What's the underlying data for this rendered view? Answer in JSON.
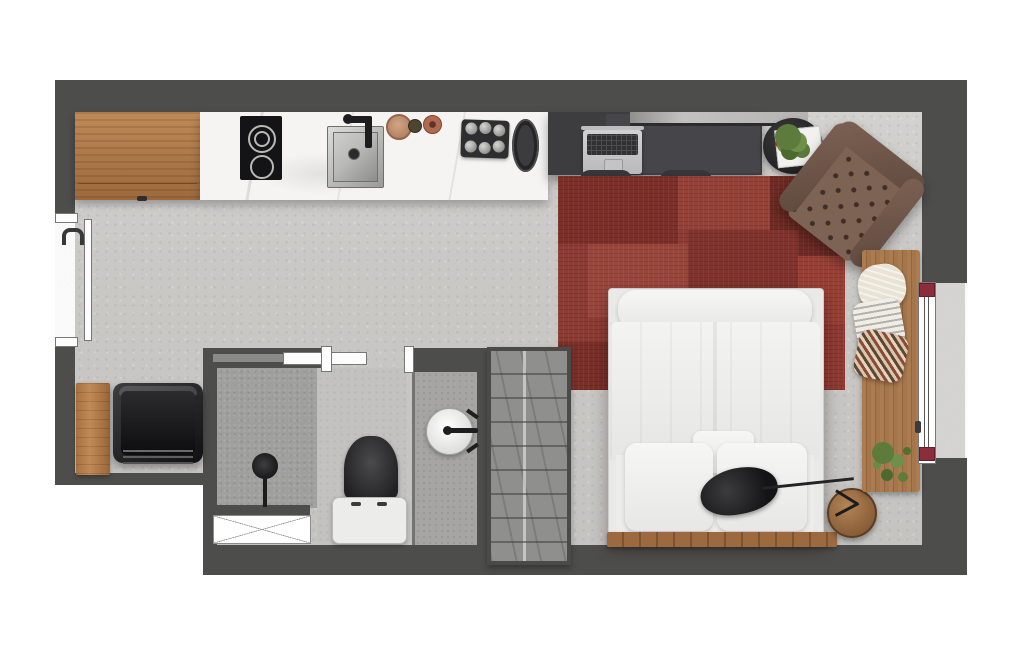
{
  "meta": {
    "type": "floor-plan",
    "description": "Top-down rendered floor plan of a studio apartment with kitchen, desk, bed, bathroom and window bench",
    "orientation": "top-down"
  },
  "colors": {
    "wall": "#4d4d4b",
    "outside": "#ffffff",
    "floor": "#cac9c6",
    "marble": "#f5f4f2",
    "wood": "#b07a4c",
    "rug": "#8e3b33",
    "desk": "#3d3d3f",
    "leather": "#6f5749",
    "bed": "#f0f0ee",
    "gray_counter": "#a5a4a2",
    "shower": "#9e9e9c",
    "bath_floor": "#c4c3c1",
    "balcony": "#d7d6d4",
    "plant": "#5d7b3c",
    "accent_red": "#8e2d3a",
    "black": "#1e1e20",
    "steel": "#c9c9c7",
    "wardrobe_gray": "#8f8f8d"
  },
  "rooms": {
    "kitchen": "Kitchen",
    "living": "Living and sleeping area",
    "bathroom": "Bathroom",
    "entry": "Entry"
  },
  "items": {
    "entry_door": "Entry door",
    "kitchen_cabinet": "Wood kitchen cabinet",
    "kitchen_counter": "Marble kitchen counter",
    "cooktop": "Two-burner cooktop",
    "kitchen_sink": "Kitchen sink with black faucet",
    "serving_board_large": "Large round serving board",
    "serving_board_small": "Small round serving board",
    "serving_board_medium": "Medium round serving board",
    "glass_tray": "Tray with six glasses",
    "platter": "Oval platter",
    "desk": "Work desk",
    "desk_shelf": "Wall shelf above desk",
    "laptop": "Open laptop",
    "desk_chair_left": "Wire desk chair",
    "desk_chair_right": "Wire desk chair",
    "plant_tray": "Round side tray with potted plant and magazine",
    "armchair": "Tufted leather armchair",
    "rug": "Red patchwork rug",
    "bed": "Double bed with duvet",
    "pillow_left": "Bed pillow",
    "pillow_right": "Bed pillow",
    "pillow_small": "Small center pillow",
    "bed_slats": "Wood slat headboard strip",
    "nightstand": "Round wood nightstand",
    "lamp": "Black task lamp",
    "window_bench": "Slatted wood window bench",
    "bench_pillow_fur": "Cream fur pillow",
    "bench_pillow_print": "Printed pillow",
    "bench_pillow_chevron": "Chevron pillow",
    "bench_plant": "Potted plant on bench",
    "window": "Window with red corner caps",
    "balcony": "Balcony slab",
    "lounge_chair": "Black lounge chair",
    "side_table": "Wood side board",
    "wardrobe": "Wardrobe with shelves",
    "sliding_door": "Sliding bathroom door",
    "door_jamb": "Door jamb",
    "shower": "Shower area",
    "shower_mixer": "Shower mixer",
    "shower_tray": "Shower tray marker",
    "toilet": "Toilet",
    "washbasin": "Round washbasin with faucet",
    "vanity": "Vanity counter"
  }
}
